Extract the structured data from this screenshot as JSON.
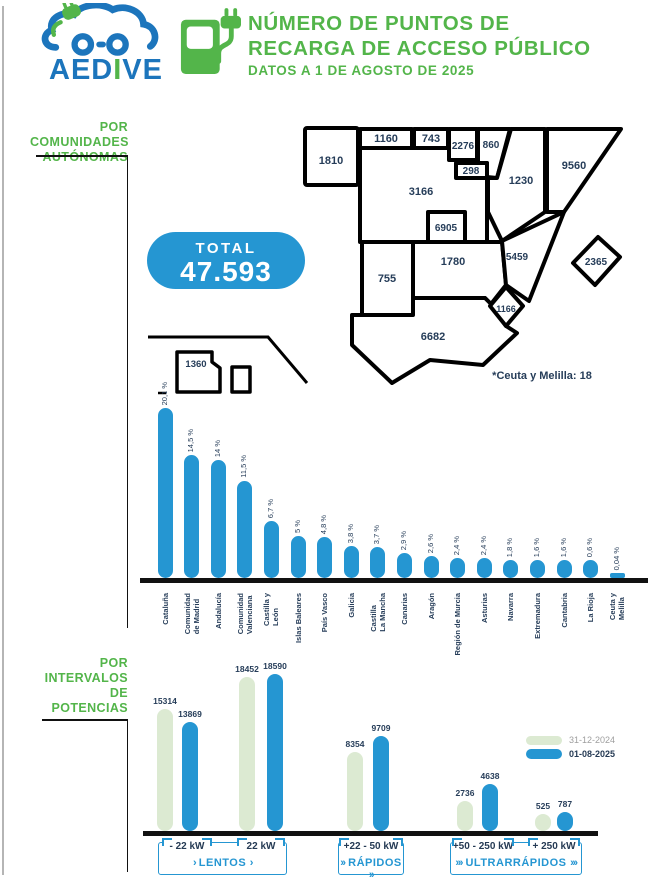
{
  "header": {
    "brand_prefix": "AED",
    "brand_i": "I",
    "brand_suffix": "VE",
    "title": "NÚMERO DE PUNTOS DE\nRECARGA DE ACCESO PÚBLICO",
    "subtitle": "DATOS A 1 DE AGOSTO DE 2025"
  },
  "colors": {
    "green": "#53b54a",
    "blue": "#2596d2",
    "navy": "#263d59",
    "light_green": "#dcead2",
    "legend_gray": "#9e9e9e",
    "brand_blue": "#1c75bc"
  },
  "sections": {
    "communities_label": "POR\nCOMUNIDADES\nAUTÓNOMAS",
    "power_label": "POR\nINTERVALOS\nDE\nPOTENCIAS"
  },
  "total_badge": {
    "label": "TOTAL",
    "value": "47.593"
  },
  "map": {
    "note": "*Ceuta y Melilla: 18",
    "regions": [
      {
        "name": "Galicia",
        "value": "1810"
      },
      {
        "name": "Asturias",
        "value": "1160"
      },
      {
        "name": "Cantabria",
        "value": "743"
      },
      {
        "name": "País Vasco",
        "value": "2276"
      },
      {
        "name": "Navarra",
        "value": "860"
      },
      {
        "name": "La Rioja",
        "value": "298"
      },
      {
        "name": "Cataluña",
        "value": "9560"
      },
      {
        "name": "Aragón",
        "value": "1230"
      },
      {
        "name": "Castilla y León",
        "value": "3166"
      },
      {
        "name": "Comunidad de Madrid",
        "value": "6905"
      },
      {
        "name": "Castilla-La Mancha",
        "value": "1780"
      },
      {
        "name": "Comunidad Valenciana",
        "value": "5459"
      },
      {
        "name": "Extremadura",
        "value": "755"
      },
      {
        "name": "Región de Murcia",
        "value": "1166"
      },
      {
        "name": "Andalucía",
        "value": "6682"
      },
      {
        "name": "Islas Baleares",
        "value": "2365"
      },
      {
        "name": "Canarias",
        "value": "1360"
      }
    ]
  },
  "chart_data": [
    {
      "type": "bar",
      "title": "Puntos de recarga por comunidad autónoma (%)",
      "categories": [
        "Cataluña",
        "Comunidad de Madrid",
        "Andalucía",
        "Comunidad Valenciana",
        "Castilla y León",
        "Islas Baleares",
        "País Vasco",
        "Galicia",
        "Castilla La Mancha",
        "Canarias",
        "Aragón",
        "Región de Murcia",
        "Asturias",
        "Navarra",
        "Extremadura",
        "Cantabria",
        "La Rioja",
        "Ceuta y Melilla"
      ],
      "category_lines": [
        [
          "Cataluña"
        ],
        [
          "Comunidad",
          "de Madrid"
        ],
        [
          "Andalucía"
        ],
        [
          "Comunidad",
          "Valenciana"
        ],
        [
          "Castilla y",
          "León"
        ],
        [
          "Islas Baleares"
        ],
        [
          "País Vasco"
        ],
        [
          "Galicia"
        ],
        [
          "Castilla",
          "La Mancha"
        ],
        [
          "Canarias"
        ],
        [
          "Aragón"
        ],
        [
          "Región de Murcia"
        ],
        [
          "Asturias"
        ],
        [
          "Navarra"
        ],
        [
          "Extremadura"
        ],
        [
          "Cantabria"
        ],
        [
          "La Rioja"
        ],
        [
          "Ceuta y",
          "Melilla"
        ]
      ],
      "values": [
        20.1,
        14.5,
        14,
        11.5,
        6.7,
        5,
        4.8,
        3.8,
        3.7,
        2.9,
        2.6,
        2.4,
        2.4,
        1.8,
        1.6,
        1.6,
        0.6,
        0.04
      ],
      "value_labels": [
        "20,1 %",
        "14,5 %",
        "14 %",
        "11,5 %",
        "6,7 %",
        "5 %",
        "4,8 %",
        "3,8 %",
        "3,7 %",
        "2,9 %",
        "2,6 %",
        "2,4 %",
        "2,4 %",
        "1,8 %",
        "1,6 %",
        "1,6 %",
        "0,6 %",
        "0,04 %"
      ],
      "xlabel": "",
      "ylabel": "",
      "grid": false
    },
    {
      "type": "bar",
      "title": "Puntos de recarga por intervalos de potencia",
      "categories": [
        "- 22 kW",
        "22 kW",
        "+22 - 50 kW",
        "+50 - 250 kW",
        "+ 250 kW"
      ],
      "series": [
        {
          "name": "31-12-2024",
          "values": [
            15314,
            18452,
            8354,
            2736,
            525
          ]
        },
        {
          "name": "01-08-2025",
          "values": [
            13869,
            18590,
            9709,
            4638,
            787
          ]
        }
      ],
      "grid": false,
      "legend_position": "right"
    }
  ],
  "legend": {
    "entries": [
      {
        "label": "31-12-2024",
        "color": "#dcead2"
      },
      {
        "label": "01-08-2025",
        "color": "#2596d2"
      }
    ]
  },
  "power_boxes": {
    "groups": [
      {
        "speed_label": "LENTOS",
        "chevron": "›",
        "chips": [
          "- 22 kW",
          "22 kW"
        ]
      },
      {
        "speed_label": "RÁPIDOS",
        "chevron": "››",
        "chips": [
          "+22 - 50 kW"
        ]
      },
      {
        "speed_label": "ULTRARRÁPIDOS",
        "chevron": "›››",
        "chips": [
          "+50 - 250 kW",
          "+ 250 kW"
        ]
      }
    ]
  }
}
